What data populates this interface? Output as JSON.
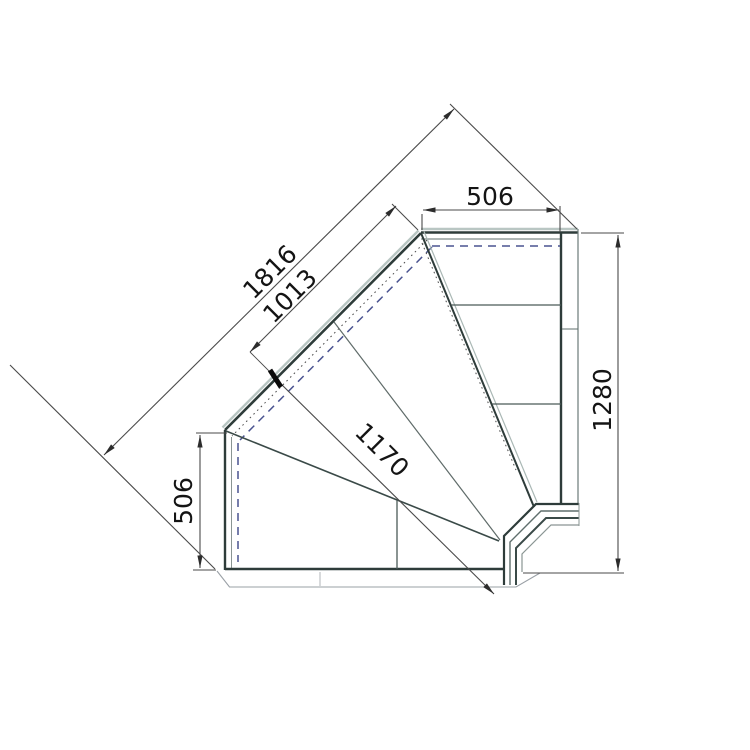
{
  "drawing": {
    "description": "plan-view technical drawing of 90-degree internal corner serve-over counter",
    "dimensions": {
      "top_width": "506",
      "diagonal_overall": "1816",
      "diagonal_glass": "1013",
      "left_depth": "506",
      "front_diagonal": "1170",
      "right_height": "1280"
    },
    "colors": {
      "line_dark": "#2e3c3a",
      "line_teal": "#5f6f6d",
      "highlight": "#b9c6c3",
      "dashed_hidden": "#4a5390",
      "dimension_line": "#4a4a4a",
      "text": "#141414"
    }
  }
}
